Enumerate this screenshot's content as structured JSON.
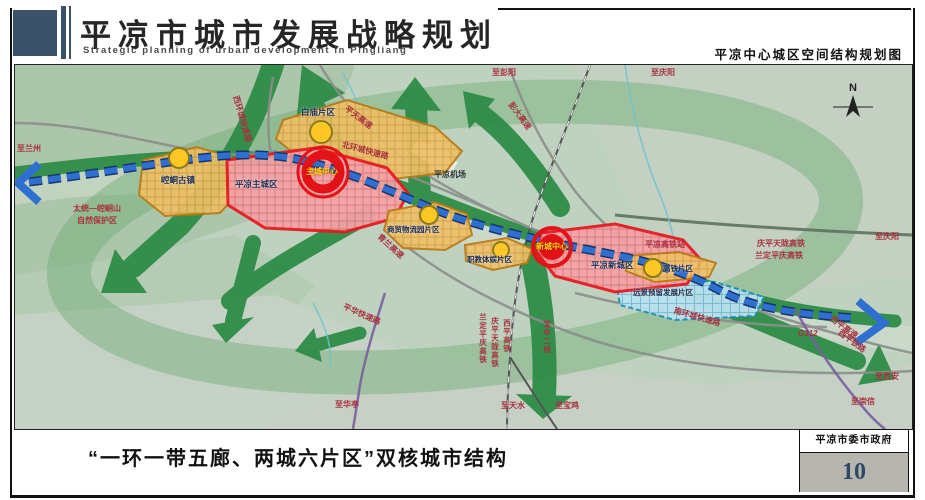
{
  "header": {
    "title": "平凉市城市发展战略规划",
    "subtitle": "Strategic planning of urban development in Pingliang",
    "map_name": "平凉中心城区空间结构规划图"
  },
  "footer": {
    "caption": "“一环一带五廊、两城六片区”双核城市结构",
    "agency": "平凉市委市政府",
    "page_number": "10"
  },
  "map": {
    "compass": "N",
    "labels": [
      {
        "text": "至兰州"
      },
      {
        "text": "太统—崆峒山"
      },
      {
        "text": "自然保护区"
      },
      {
        "text": "西环城快速路"
      },
      {
        "text": "平天高速"
      },
      {
        "text": "北环城快速路"
      },
      {
        "text": "至彭阳"
      },
      {
        "text": "彭大高速"
      },
      {
        "text": "至庆阳"
      },
      {
        "text": "平凉机场"
      },
      {
        "text": "青兰高速"
      },
      {
        "text": "平凉高铁站"
      },
      {
        "text": "庆平天陇高铁"
      },
      {
        "text": "兰定平庆高铁"
      },
      {
        "text": "至庆阳"
      },
      {
        "text": "G312"
      },
      {
        "text": "西平高速"
      },
      {
        "text": "西平铁路"
      },
      {
        "text": "至西安"
      },
      {
        "text": "至崇信"
      },
      {
        "text": "南环城快速路"
      },
      {
        "text": "平华快速路"
      },
      {
        "text": "至华亭"
      },
      {
        "text": "兰定平庆高铁"
      },
      {
        "text": "庆平天陇高铁"
      },
      {
        "text": "西平高铁"
      },
      {
        "text": "宝中二线"
      },
      {
        "text": "至天水"
      },
      {
        "text": "至宝鸡"
      },
      {
        "text": "崆峒古镇"
      },
      {
        "text": "白庙片区"
      },
      {
        "text": "平凉主城区"
      },
      {
        "text": "主城中心"
      },
      {
        "text": "商贸物流园片区"
      },
      {
        "text": "职教体娱片区"
      },
      {
        "text": "平凉新城区"
      },
      {
        "text": "新城中心"
      },
      {
        "text": "高铁片区"
      },
      {
        "text": "远景预留发展片区"
      }
    ]
  },
  "colors": {
    "header_block": "#3a5268",
    "page_number_text": "#2e4a66",
    "corridor_green": "#2e8c47",
    "belt_blue": "#2f6fd0",
    "main_city_border": "#e51c23",
    "district_orange": "#eec068",
    "reserve_cyan": "#b9e2ef",
    "node_yellow": "#ffc726",
    "label_red": "#a8303e"
  }
}
